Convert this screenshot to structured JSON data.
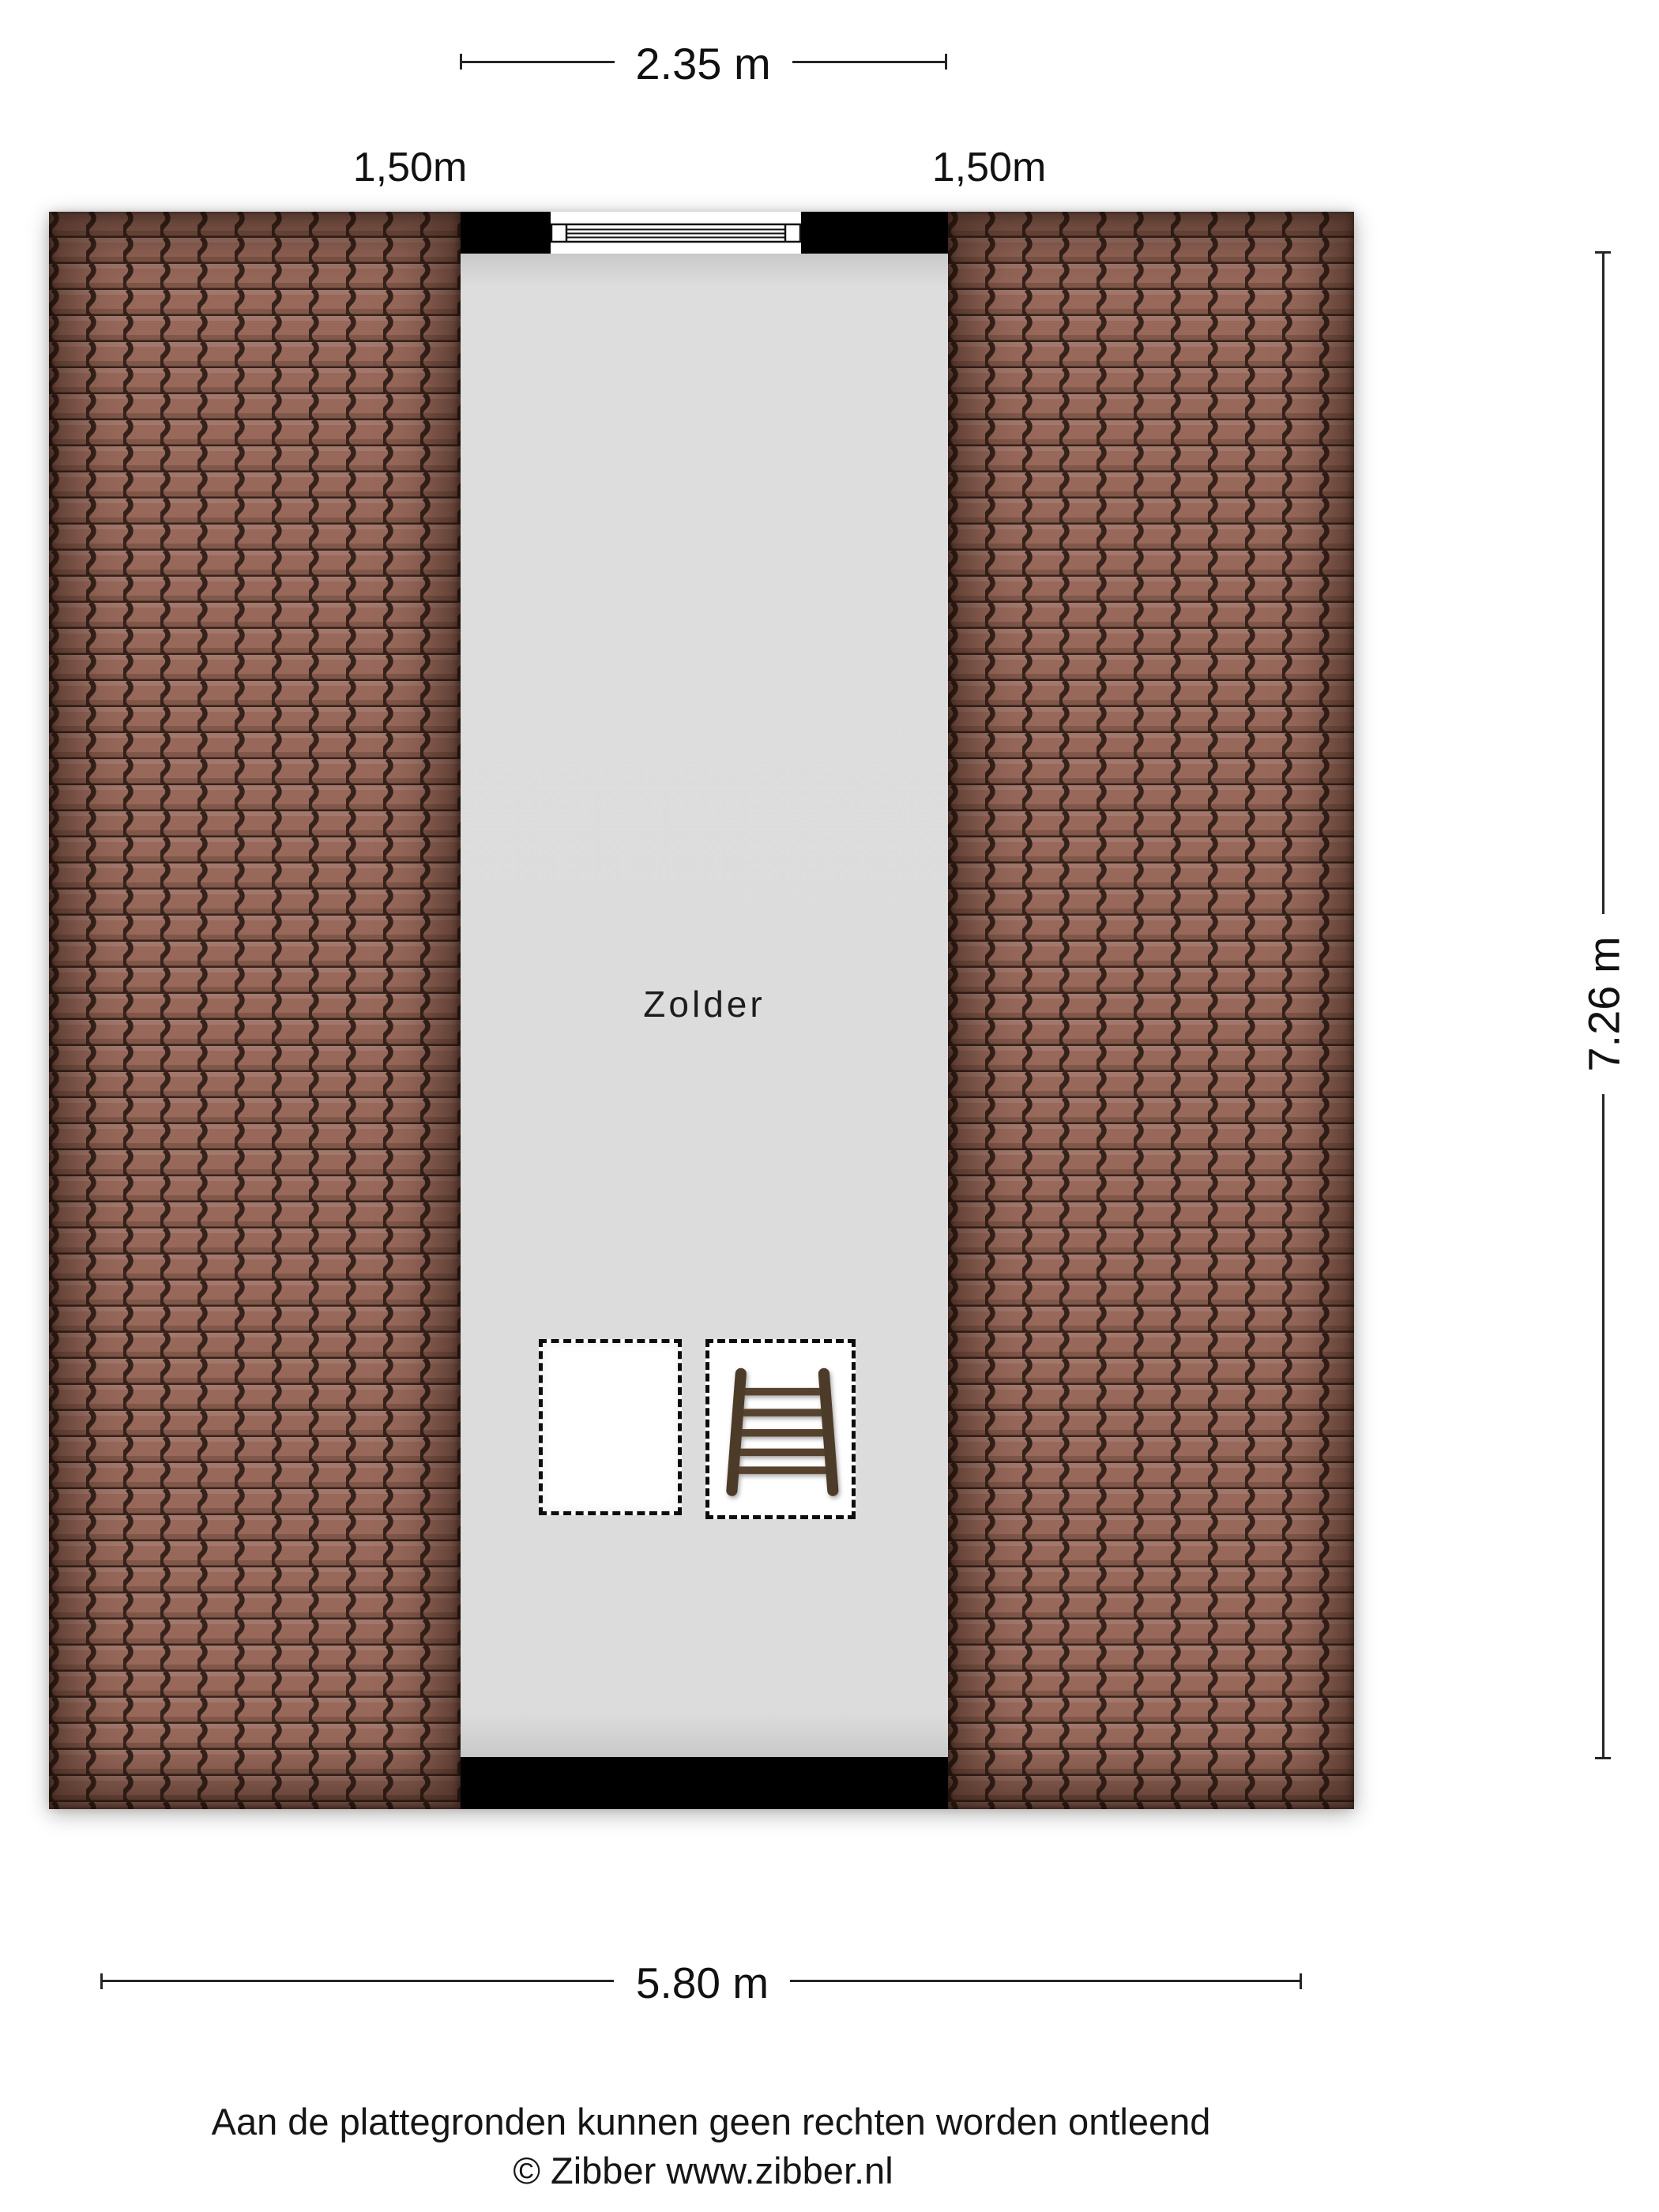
{
  "floorplan": {
    "room_label": "Zolder",
    "dimensions": {
      "top_width": "2.35 m",
      "left_slope": "1,50m",
      "right_slope": "1,50m",
      "side_height": "7.26 m",
      "bottom_width": "5.80 m"
    },
    "footer": {
      "disclaimer": "Aan de plattegronden kunnen geen rechten worden ontleend",
      "copyright": "© Zibber www.zibber.nl"
    },
    "colors": {
      "roof_tile": "#98695b",
      "roof_tile_line": "#35221b",
      "floor": "#dcdcdc",
      "wall": "#000000",
      "dimension_line": "#262626"
    }
  }
}
